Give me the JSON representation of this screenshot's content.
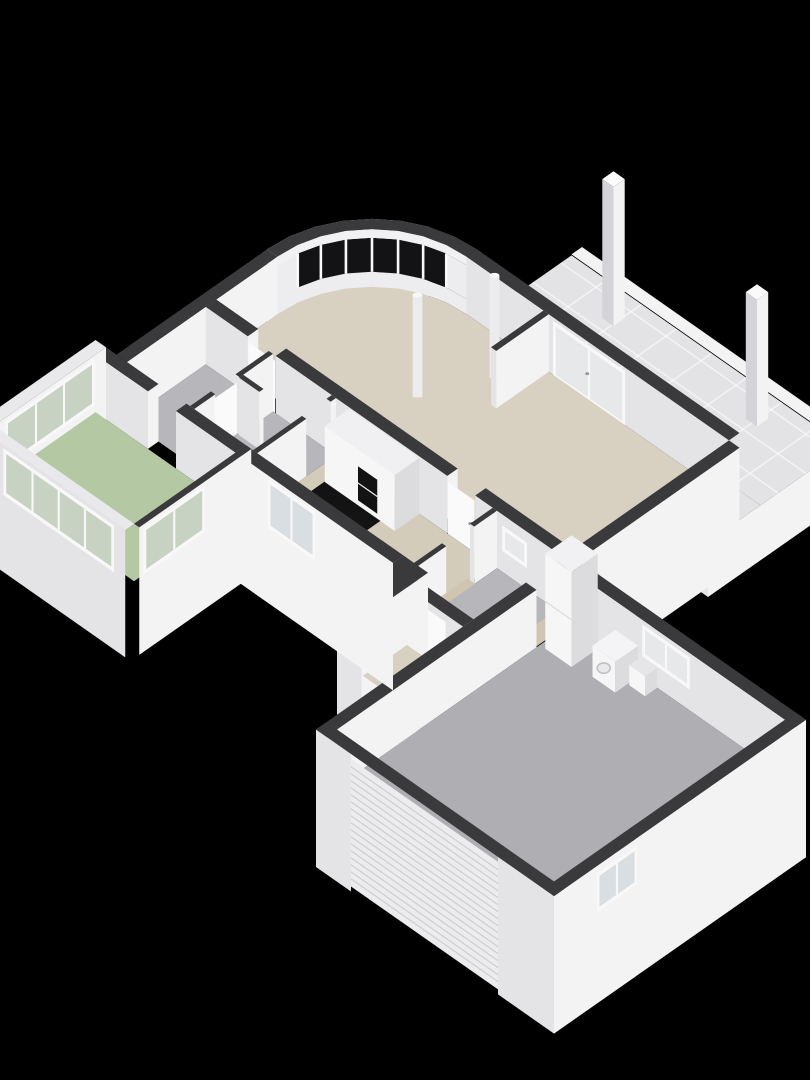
{
  "scene": {
    "type": "3d-floorplan-cutaway",
    "view": "isometric-birds-eye",
    "rooms": [
      {
        "id": "living-dining",
        "floor": "floor_beige",
        "features": [
          "curved-bay-window",
          "sliding-glass-door",
          "round-column",
          "round-column",
          "wall-stub"
        ]
      },
      {
        "id": "patio",
        "floor": "tile",
        "features": [
          "tile-grid",
          "pergola-pillar",
          "pergola-pillar",
          "edge-curb"
        ]
      },
      {
        "id": "hallway",
        "floor": "floor_gray",
        "features": [
          "interior-door",
          "interior-door"
        ]
      },
      {
        "id": "kitchen",
        "floor": "floor_beige",
        "features": [
          "tall-cabinet-run",
          "built-in-oven",
          "dark-floor-mat",
          "facade-window"
        ]
      },
      {
        "id": "sunroom",
        "floor": "floor_green",
        "features": [
          "corner-window-band",
          "door-to-hall"
        ]
      },
      {
        "id": "utility-hall",
        "floor": "floor_gray",
        "features": [
          "door-to-kitchen",
          "door-to-garage",
          "small-window",
          "threshold",
          "threshold"
        ]
      },
      {
        "id": "entry-porch",
        "floor": "floor_beige",
        "features": [
          "front-door",
          "recessed-opening"
        ]
      },
      {
        "id": "garage",
        "floor": "floor_garage",
        "features": [
          "sectional-garage-door",
          "tall-storage-cabinet",
          "washing-machine",
          "utility-sink",
          "rear-window",
          "side-window"
        ]
      }
    ],
    "pillar_count": 2,
    "column_count": 2,
    "bay_window_panes": 6,
    "sliding_door_panels": 2
  },
  "palette": {
    "background": "#000000",
    "wall_cap": "#3a3a3c",
    "wall_white": "#f3f3f4",
    "wall_light": "#e4e4e7",
    "wall_shade": "#d4d4d8",
    "floor_beige": "#d8d0c0",
    "floor_beige_kitchen": "#d4ccbb",
    "floor_gray": "#b7b7bb",
    "floor_garage": "#afafb3",
    "floor_green": "#b5c8a4",
    "tile": "#e3e3e6",
    "tile_line": "#ffffff",
    "threshold_beige": "#cfc5b1",
    "glass_dark": "#131315",
    "glass_light": "#e6e8ea",
    "glass_green": "#c8d2c3",
    "glass_ext": "#d9dee2",
    "appliance_black": "#131313",
    "object_white": "#f6f6f7",
    "object_side": "#dcdcdf",
    "door_white": "#fafafa",
    "rib_line": "#cdcdd1",
    "frame_white": "#f8f8f9"
  }
}
